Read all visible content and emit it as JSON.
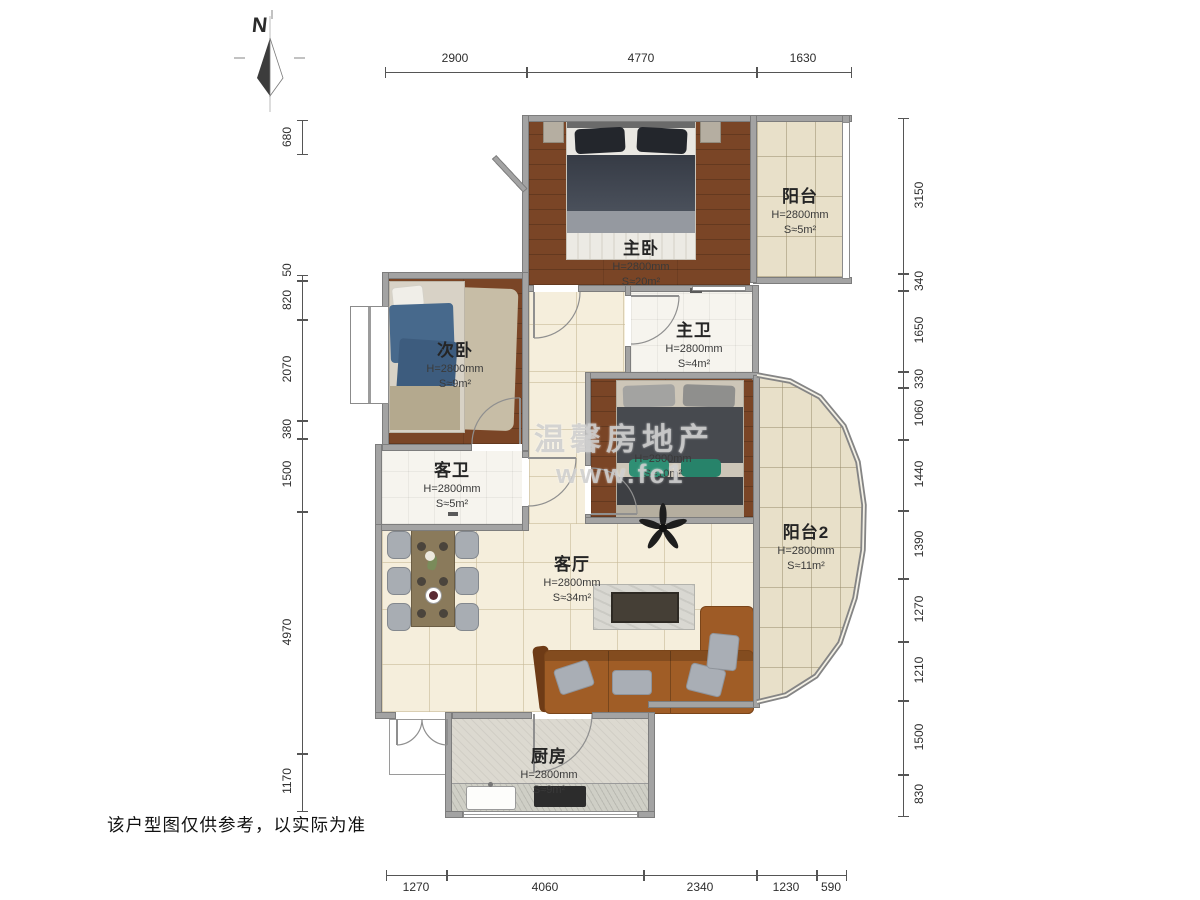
{
  "compass": {
    "label": "N"
  },
  "watermark": {
    "line1": "温馨房地产",
    "line2": "www.fc1"
  },
  "disclaimer": "该户型图仅供参考，以实际为准",
  "rooms": {
    "master_bedroom": {
      "name": "主卧",
      "h": "H=2800mm",
      "s": "S≈20m²"
    },
    "balcony": {
      "name": "阳台",
      "h": "H=2800mm",
      "s": "S≈5m²"
    },
    "master_bath": {
      "name": "主卫",
      "h": "H=2800mm",
      "s": "S≈4m²"
    },
    "second_bedroom": {
      "name": "次卧",
      "h": "H=2800mm",
      "s": "S≈9m²"
    },
    "guest_bath": {
      "name": "客卫",
      "h": "H=2800mm",
      "s": "S≈5m²"
    },
    "bedroom3": {
      "h": "H=2900mm",
      "s": "S≈10m²"
    },
    "living": {
      "name": "客厅",
      "h": "H=2800mm",
      "s": "S≈34m²"
    },
    "balcony2": {
      "name": "阳台2",
      "h": "H=2800mm",
      "s": "S≈11m²"
    },
    "kitchen": {
      "name": "厨房",
      "h": "H=2800mm",
      "s": "S≈9m²"
    }
  },
  "dimensions": {
    "top": [
      "2900",
      "4770",
      "1630"
    ],
    "bottom": [
      "1270",
      "4060",
      "2340",
      "1230",
      "590"
    ],
    "left": [
      "680",
      "50",
      "820",
      "2070",
      "380",
      "1500",
      "4970",
      "1170"
    ],
    "right": [
      "3150",
      "340",
      "1650",
      "330",
      "1060",
      "1440",
      "1390",
      "1270",
      "1210",
      "1500",
      "830"
    ]
  },
  "colors": {
    "wall": "#a3a3a3",
    "wood_floor": "#7a4526",
    "tile_floor": "#e8e0c9",
    "living_floor": "#f5eedc",
    "bath_floor": "#f6f4ee",
    "kitchen_floor": "#dcd9d0",
    "sofa": "#a05d26",
    "accent_teal": "#2f8f74"
  }
}
